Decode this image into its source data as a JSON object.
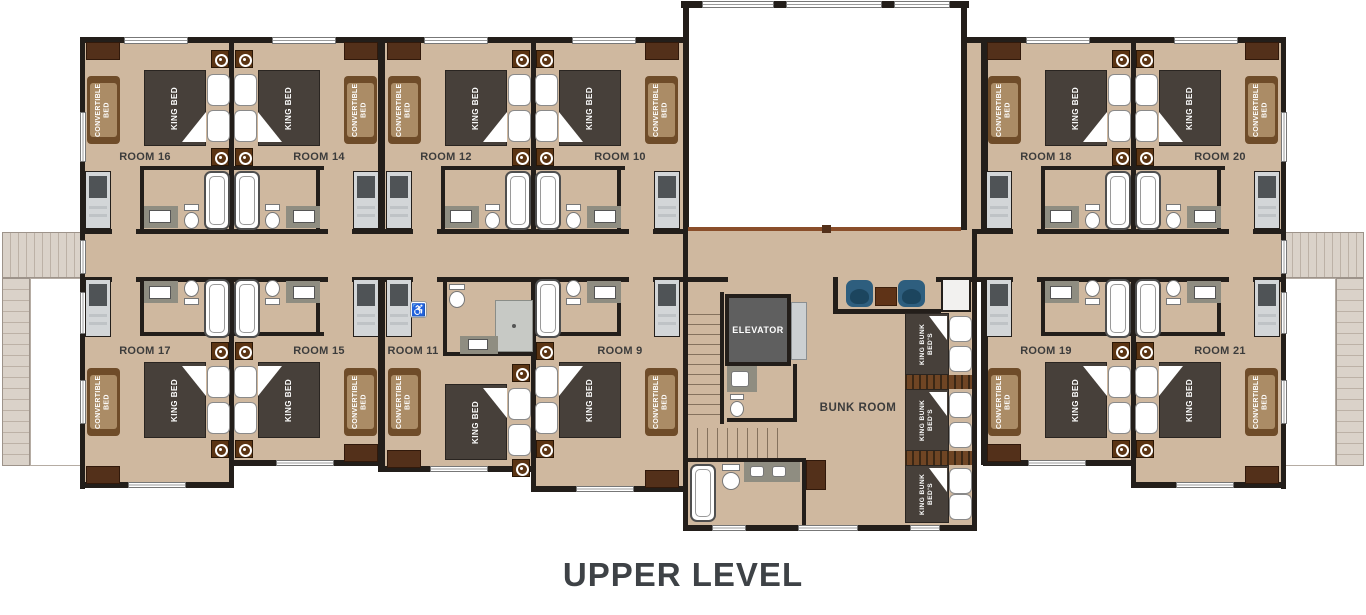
{
  "title": "UPPER LEVEL",
  "labels": {
    "king_bed": "KING BED",
    "convertible_bed": "CONVERTIBLE BED",
    "elevator": "ELEVATOR",
    "bunk_room": "BUNK ROOM"
  },
  "icons": {
    "accessibility": "♿"
  },
  "rooms": [
    {
      "label": "ROOM 16"
    },
    {
      "label": "ROOM 14"
    },
    {
      "label": "ROOM 12"
    },
    {
      "label": "ROOM 10"
    },
    {
      "label": "ROOM 18"
    },
    {
      "label": "ROOM 20"
    },
    {
      "label": "ROOM 17"
    },
    {
      "label": "ROOM 15"
    },
    {
      "label": "ROOM 11"
    },
    {
      "label": "ROOM 9"
    },
    {
      "label": "ROOM 19"
    },
    {
      "label": "ROOM 21"
    }
  ],
  "bunk_beds": [
    "KING BUNK BED'S",
    "KING BUNK BED'S",
    "KING BUNK BED'S"
  ],
  "colors": {
    "floor": "#cfb89f",
    "wall": "#231e1a",
    "bed": "#47403a",
    "convertible_bed": "#ab8c66",
    "wood_trim": "#6f4c29",
    "nightstand": "#5b3413",
    "chair": "#2e5e7e",
    "elevator": "#5f5f5f",
    "deck": "#dad2c9",
    "railing": "#8a4e2a",
    "title_text": "#3e4246"
  }
}
